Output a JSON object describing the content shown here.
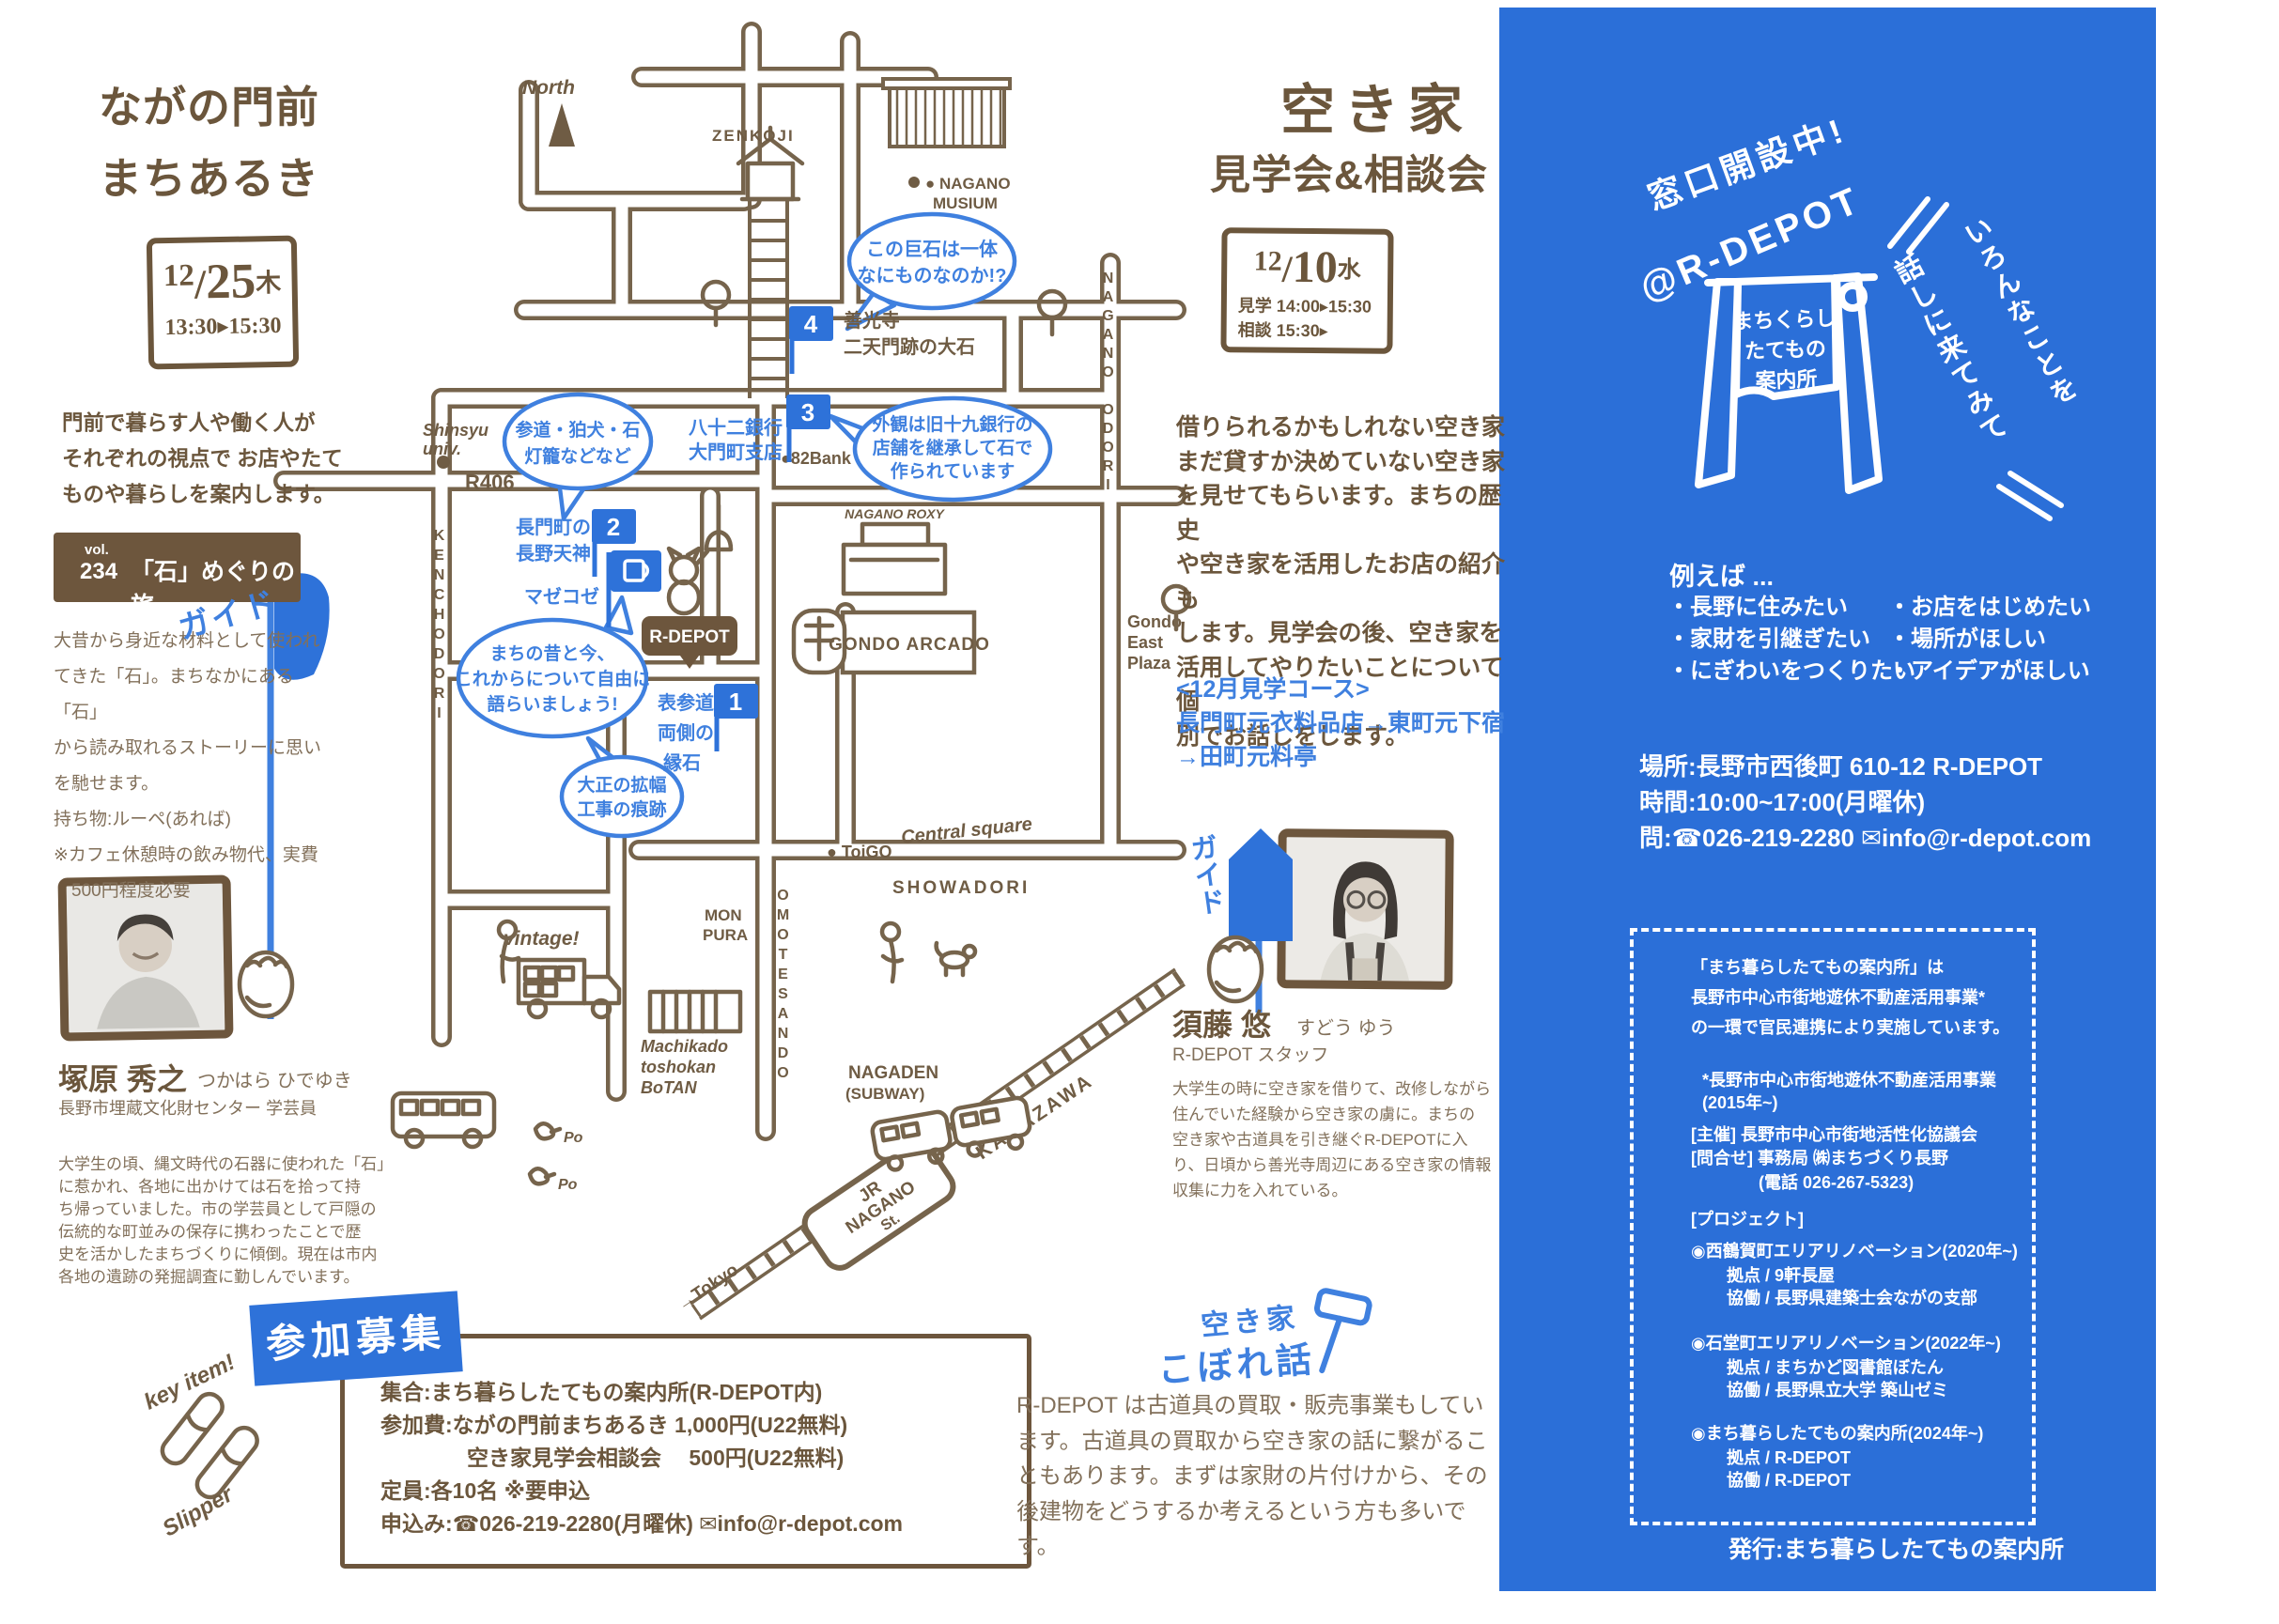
{
  "colors": {
    "brown": "#6b563c",
    "brown_light": "#82705a",
    "blue": "#2e72d9",
    "map_blue": "#3f80df"
  },
  "left": {
    "title": [
      "ながの門前",
      "まちあるき"
    ],
    "date_box": {
      "month": "12",
      "day": "25",
      "weekday": "木",
      "time": "13:30▸15:30"
    },
    "intro": [
      "門前で暮らす人や働く人が",
      "それぞれの視点で お店やたて",
      "ものや暮らしを案内します。"
    ],
    "vol": {
      "label": "vol.",
      "number": "234",
      "title": "「石」めぐりの旅"
    },
    "body": [
      "大昔から身近な材料として使われ",
      "てきた「石」。まちなかにある「石」",
      "から読み取れるストーリーに思い",
      "を馳せます。",
      "持ち物:ルーペ(あれば)",
      "※カフェ休憩時の飲み物代、実費",
      "　500円程度必要"
    ],
    "guide": {
      "flag": "ガイド",
      "name": "塚原 秀之",
      "kana": "つかはら ひでゆき",
      "title": "長野市埋蔵文化財センター 学芸員",
      "bio": [
        "大学生の頃、縄文時代の石器に使われた「石」",
        "に惹かれ、各地に出かけては石を拾って持",
        "ち帰っていました。市の学芸員として戸隠の",
        "伝統的な町並みの保存に携わったことで歴",
        "史を活かしたまちづくりに傾倒。現在は市内",
        "各地の遺跡の発掘調査に勤しんでいます。"
      ]
    },
    "key_item": {
      "top": "key item!",
      "bottom": "Slipper"
    },
    "recruit": {
      "badge": "参加募集",
      "lines": [
        "集合:まち暮らしたてもの案内所(R-DEPOT内)",
        "参加費:ながの門前まちあるき 1,000円(U22無料)",
        "　　　　空き家見学会相談会　 500円(U22無料)",
        "定員:各10名 ※要申込",
        "申込み:☎026-219-2280(月曜休) ✉info@r-depot.com"
      ]
    }
  },
  "map": {
    "north": "North",
    "zenkoji": "ZENKOJI",
    "musium": [
      "● NAGANO",
      "MUSIUM"
    ],
    "shinsyu": [
      "Shinsyu",
      "univ."
    ],
    "r406": "R406",
    "bank82": "●82Bank",
    "streets": {
      "kenchodori": "KENCHODORI",
      "omotesando": "OMOTESANDO",
      "naganoodori": "NAGANO ODORI",
      "showadori": "SHOWADORI"
    },
    "toigo": "● ToiGO",
    "central_square": "Central square",
    "mon_pura": [
      "MON",
      "PURA"
    ],
    "vintage": "vintage!",
    "machikado": [
      "Machikado",
      "toshokan",
      "BoTAN"
    ],
    "nagaden": [
      "NAGADEN",
      "(SUBWAY)"
    ],
    "jr": [
      "JR",
      "NAGANO",
      "St."
    ],
    "kanazawa": "KANAZAWA",
    "tokyo": "→Tokyo",
    "popo": [
      "Po",
      "Po"
    ],
    "gondo_arcado": "GONDO ARCADO",
    "nagano_roxy": "NAGANO ROXY",
    "gondo_east": [
      "Gondo",
      "East",
      "Plaza"
    ],
    "rdepot": "R-DEPOT",
    "mazekoze": "マゼコゼ",
    "spot1": {
      "num": "1",
      "label": [
        "表参道",
        "両側の",
        "縁石"
      ]
    },
    "spot2": {
      "num": "2",
      "label": [
        "長門町の",
        "長野天神"
      ]
    },
    "spot3": {
      "num": "3",
      "label": [
        "八十二銀行",
        "大門町支店"
      ]
    },
    "spot4": {
      "num": "4",
      "label": [
        "善光寺",
        "二天門跡の大石"
      ]
    },
    "bubble1": [
      "この巨石は一体",
      "なにものなのか!?"
    ],
    "bubble2": [
      "外観は旧十九銀行の",
      "店舗を継承して石で",
      "作られています"
    ],
    "bubble3": [
      "参道・狛犬・石",
      "灯籠などなど"
    ],
    "bubble4": [
      "まちの昔と今、",
      "これからについて自由に",
      "語らいましょう!"
    ],
    "bubble5": [
      "大正の拡幅",
      "工事の痕跡"
    ]
  },
  "right": {
    "title": [
      "空き家",
      "見学会&相談会"
    ],
    "date_box": {
      "month": "12",
      "day": "10",
      "weekday": "水",
      "line1": "見学 14:00▸15:30",
      "line2": "相談 15:30▸"
    },
    "intro": [
      "借りられるかもしれない空き家",
      "まだ貸すか決めていない空き家",
      "を見せてもらいます。まちの歴史",
      "や空き家を活用したお店の紹介も",
      "します。見学会の後、空き家を",
      "活用してやりたいことについて個",
      "別でお話しをします。"
    ],
    "course": [
      "<12月見学コース>",
      "長門町元衣料品店→東町元下宿",
      "→田町元料亭"
    ],
    "guide": {
      "flag": "ガイド",
      "name": "須藤 悠",
      "kana": "すどう ゆう",
      "title": "R-DEPOT スタッフ",
      "bio": [
        "大学生の時に空き家を借りて、改修しながら",
        "住んでいた経験から空き家の虜に。まちの",
        "空き家や古道具を引き継ぐR-DEPOTに入",
        "り、日頃から善光寺周辺にある空き家の情報",
        "収集に力を入れている。"
      ]
    },
    "kobore": {
      "title": [
        "空き家",
        "こぼれ話"
      ],
      "text": [
        "R-DEPOT は古道具の買取・販売事業もしてい",
        "ます。古道具の買取から空き家の話に繋がるこ",
        "ともあります。まずは家財の片付けから、その",
        "後建物をどうするか考えるという方も多いです。"
      ]
    }
  },
  "panel": {
    "open": "窓口開設中!",
    "at": "@R-DEPOT",
    "sign": [
      "まちくらし",
      "たてもの",
      "案内所"
    ],
    "invite": [
      "いろんなことを",
      "話しに来てみて"
    ],
    "example_label": "例えば ...",
    "examples_left": [
      "・長野に住みたい",
      "・家財を引継ぎたい",
      "・にぎわいをつくりたい"
    ],
    "examples_right": [
      "・お店をはじめたい",
      "・場所がほしい",
      "・アイデアがほしい"
    ],
    "place": "場所:長野市西後町 610-12 R-DEPOT",
    "hours": "時間:10:00~17:00(月曜休)",
    "contact": "問:☎026-219-2280 ✉info@r-depot.com",
    "box": {
      "p1": [
        "「まち暮らしたてもの案内所」は",
        "長野市中心市街地遊休不動産活用事業*",
        "の一環で官民連携により実施しています。"
      ],
      "note": [
        "*長野市中心市街地遊休不動産活用事業",
        "(2015年~)"
      ],
      "host": "[主催] 長野市中心市街地活性化協議会",
      "inquiry": [
        "[問合せ] 事務局 ㈱まちづくり長野",
        "　　　　(電話 026-267-5323)"
      ],
      "project_label": "[プロジェクト]",
      "projects": [
        {
          "title": "◉西鶴賀町エリアリノベーション(2020年~)",
          "lines": [
            "拠点 / 9軒長屋",
            "協働 / 長野県建築士会ながの支部"
          ]
        },
        {
          "title": "◉石堂町エリアリノベーション(2022年~)",
          "lines": [
            "拠点 / まちかど図書館ぼたん",
            "協働 / 長野県立大学 築山ゼミ"
          ]
        },
        {
          "title": "◉まち暮らしたてもの案内所(2024年~)",
          "lines": [
            "拠点 / R-DEPOT",
            "協働 / R-DEPOT"
          ]
        }
      ]
    },
    "publisher": "発行:まち暮らしたてもの案内所"
  }
}
